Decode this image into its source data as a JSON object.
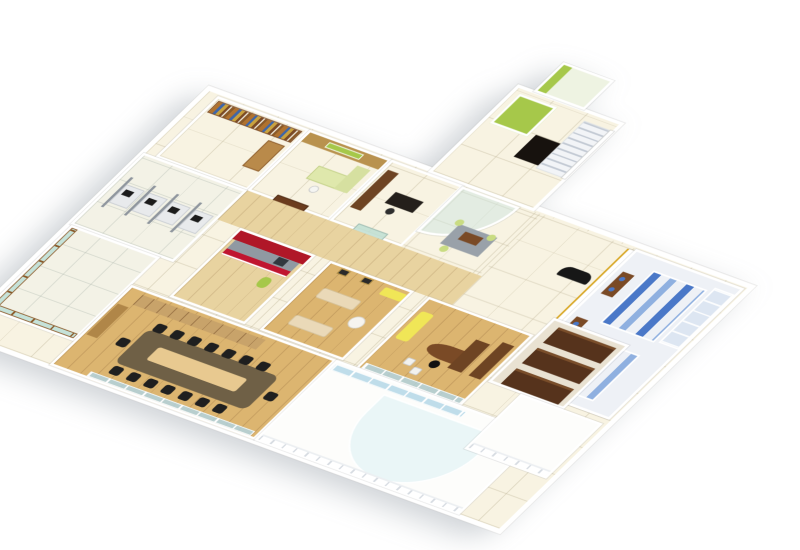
{
  "scene": {
    "type": "3d-isometric-office-floor-plan-render",
    "background": "#ffffff",
    "palette": {
      "wall": "#ffffff",
      "tile_floor": "#f8f3e2",
      "wood_floor": "#dcb570",
      "dark_wood": "#56331c",
      "mid_wood": "#7a4a26",
      "glass": "#cde6e0",
      "accent_red": "#b01728",
      "accent_red_bright": "#c01530",
      "accent_green": "#a6c84a",
      "accent_lime": "#c9dc82",
      "accent_yellow": "#f0e657",
      "accent_blue": "#4a78c8",
      "accent_blue_light": "#8fb0e0",
      "accent_gold": "#d8a520",
      "sofa_black": "#171717",
      "sofa_cream": "#ead9b8"
    },
    "rooms": [
      {
        "name": "library-storage-room",
        "furniture": [
          "bookshelf-wall",
          "side-cabinet"
        ]
      },
      {
        "name": "manager-cabin",
        "furniture": [
          "wood-panel-wall",
          "green-name-board",
          "desk",
          "chair",
          "wooden-double-door"
        ]
      },
      {
        "name": "private-cabin",
        "furniture": [
          "display-cabinet",
          "work-desk",
          "chair",
          "glass-door"
        ]
      },
      {
        "name": "reception-waiting-area",
        "furniture": [
          "curved-glass-partition",
          "rug",
          "coffee-table",
          "lime-visitor-chairs"
        ]
      },
      {
        "name": "lobby",
        "furniture": [
          "black-sofa",
          "gold-trim-wall"
        ]
      },
      {
        "name": "restrooms",
        "furniture": [
          "vanity-counters",
          "wash-basins",
          "blue-toilet-stalls",
          "shelf-cubbies"
        ]
      },
      {
        "name": "entry-stair-hall",
        "furniture": [
          "staircase",
          "elevator",
          "green-utility-room"
        ]
      },
      {
        "name": "terrace-room",
        "furniture": [
          "green-accent-wall"
        ]
      },
      {
        "name": "corridor",
        "furniture": []
      },
      {
        "name": "open-office",
        "furniture": [
          "workstation-desks",
          "partitions",
          "monitors"
        ]
      },
      {
        "name": "pantry",
        "furniture": [
          "red-feature-wall",
          "kitchen-counter",
          "appliance",
          "water-jug"
        ]
      },
      {
        "name": "lounge",
        "furniture": [
          "cream-sofas",
          "round-table",
          "yellow-bench",
          "wall-art"
        ]
      },
      {
        "name": "executive-office",
        "furniture": [
          "curved-executive-desk",
          "office-chair",
          "guest-chairs",
          "yellow-sofa",
          "credenza",
          "glass-front-wall"
        ]
      },
      {
        "name": "storage-room",
        "furniture": [
          "wardrobe-cabinets"
        ]
      },
      {
        "name": "terrace-balcony",
        "furniture": [
          "glass-railing"
        ]
      },
      {
        "name": "conference-room",
        "furniture": [
          "long-conference-table",
          "light-wood-inlay",
          "black-chairs",
          "credenza",
          "window-wall"
        ]
      },
      {
        "name": "front-balcony",
        "furniture": [
          "curved-glass-canopy",
          "railing",
          "window-band"
        ]
      },
      {
        "name": "side-deck",
        "furniture": [
          "railing"
        ]
      }
    ]
  }
}
